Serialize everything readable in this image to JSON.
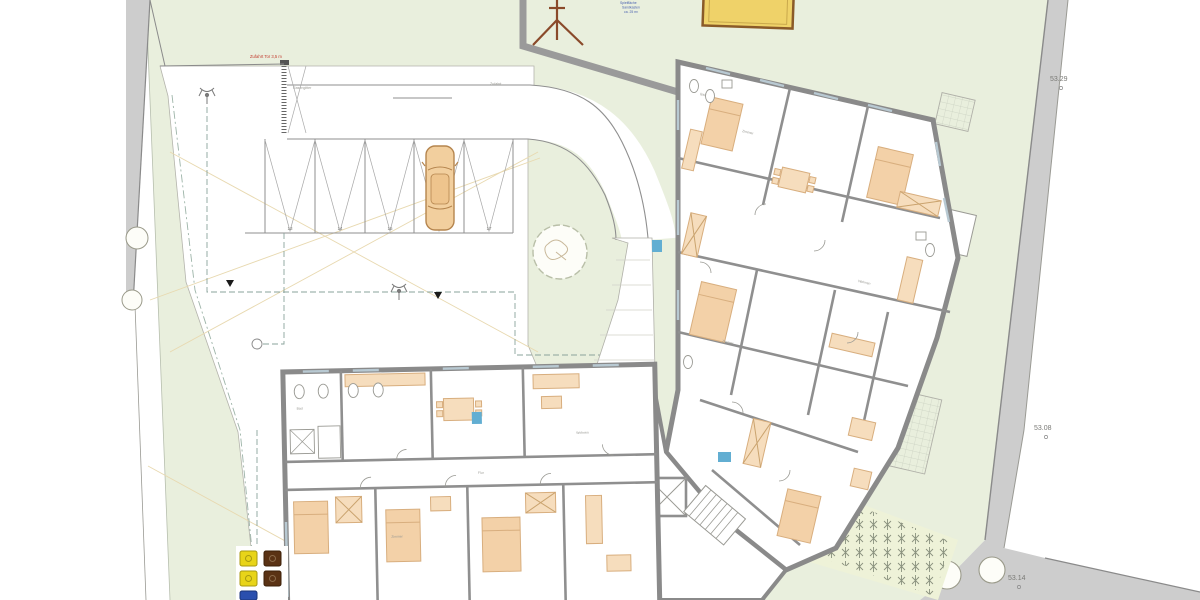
{
  "plan": {
    "title": "site-floor-plan",
    "elevations": {
      "top_right": "53.29",
      "mid_right": "53.08",
      "bottom_right": "53.14"
    },
    "parking": {
      "stall_numbers": [
        "13",
        "14",
        "15",
        "16",
        "17"
      ]
    },
    "annotations": {
      "gate_red": "Zufahrt Tor 3,5 m",
      "surface_left": "Rasengitter",
      "surface_right": "Zufahrt",
      "play_line1": "Spielfläche",
      "play_line2": "Sandkasten",
      "play_line3": "ca. 25 m²"
    },
    "room_labels": [
      "Bad",
      "Zimmer",
      "Wohnen",
      "Zimmer",
      "Wohnen",
      "Flur",
      "Zimmer",
      "Bad"
    ],
    "colors": {
      "site_green": "#e9efdd",
      "road_gray": "#cdcdcd",
      "wall_gray": "#8a8a8a",
      "furniture_tan": "#f6ddbd",
      "bed_tan": "#f3d1a8",
      "sandbox_yellow": "#efd269",
      "car_tan": "#f2cf9e",
      "fixture_blue": "#62aed2",
      "utility_dash": "#8aa39b"
    }
  }
}
